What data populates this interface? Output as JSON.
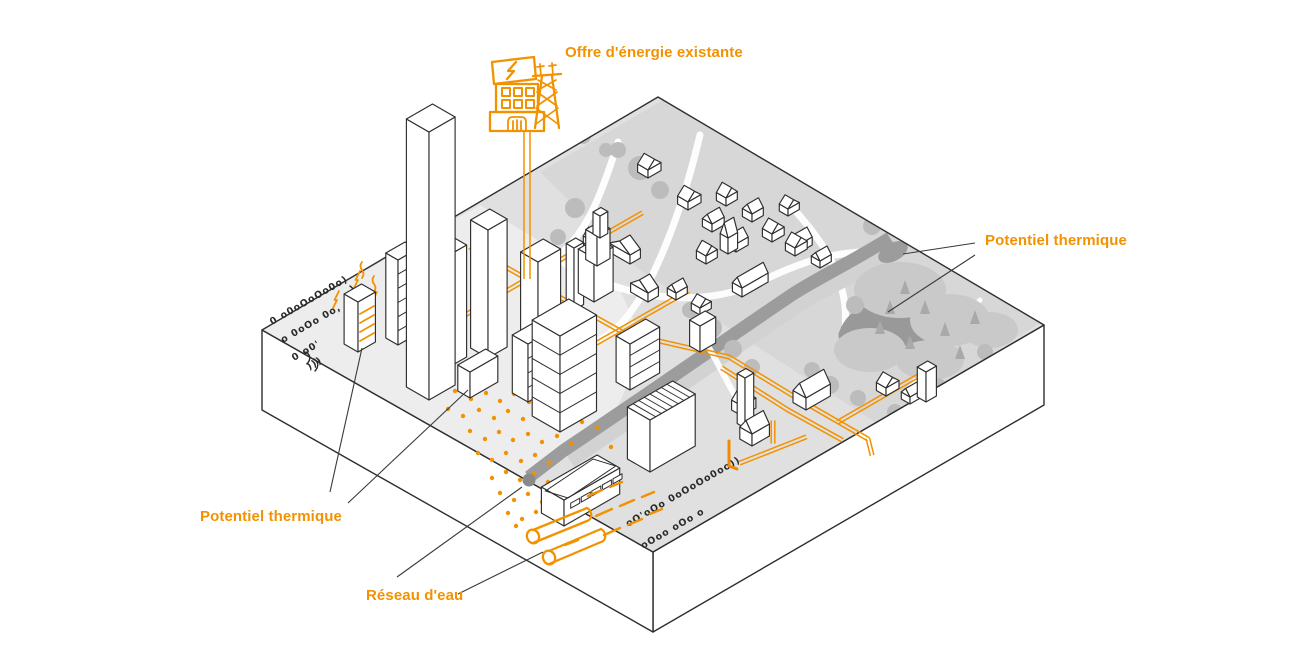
{
  "diagram": {
    "labels": {
      "energy_supply": "Offre d'énergie existante",
      "thermal_potential_right": "Potentiel thermique",
      "thermal_potential_left": "Potentiel thermique",
      "water_network": "Réseau d'eau"
    },
    "colors": {
      "accent": "#F39200",
      "accent_bright": "#F28A00",
      "leader_line": "#3a3a3a",
      "outline": "#2e2e2e",
      "doodle": "#2a2a2a",
      "map_base": "#e0e0e0",
      "map_park": "#d7d7d7",
      "map_light": "#ededed",
      "forest": "#c9c9c9",
      "tree": "#bcbcbc",
      "pine": "#a9a9a9",
      "river": "#9c9c9c",
      "river_bank": "#d2d2d2",
      "lake": "#999999",
      "river_end": "#8a8a8a",
      "building_fill": "#ffffff",
      "path_white": "#ffffff"
    },
    "icons": {
      "power_plant": "power-plant-icon",
      "transmission_tower": "transmission-tower-icon"
    }
  }
}
